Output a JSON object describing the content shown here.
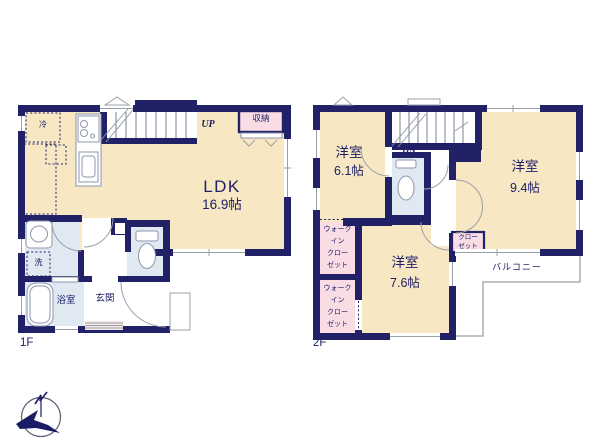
{
  "colors": {
    "wall": "#212168",
    "floor": "#f7e7c3",
    "wet_area": "#e0e9f2",
    "closet_pink": "#f9dce4",
    "outline_gray": "#9aa0a8",
    "text_navy": "#1f2068"
  },
  "floor1": {
    "label": "1F",
    "ldk": {
      "name": "LDK",
      "area": "16.9帖"
    },
    "storage_label": "収納",
    "fridge_label": "冷",
    "stairs_label": "UP",
    "laundry_label": "洗",
    "bathroom_label": "浴室",
    "entrance_label": "玄関"
  },
  "floor2": {
    "label": "2F",
    "room_61": {
      "name": "洋室",
      "area": "6.1帖"
    },
    "room_94": {
      "name": "洋室",
      "area": "9.4帖"
    },
    "room_76": {
      "name": "洋室",
      "area": "7.6帖"
    },
    "stairs_label": "DN",
    "walkin_closet_1": {
      "line1": "ウォーク",
      "line2": "イン",
      "line3": "クロー",
      "line4": "ゼット"
    },
    "walkin_closet_2": {
      "line1": "ウォーク",
      "line2": "イン",
      "line3": "クロー",
      "line4": "ゼット"
    },
    "closet": {
      "line1": "クロー",
      "line2": "ゼット"
    },
    "balcony_label": "バルコニー"
  },
  "compass": {
    "mark": "N"
  }
}
